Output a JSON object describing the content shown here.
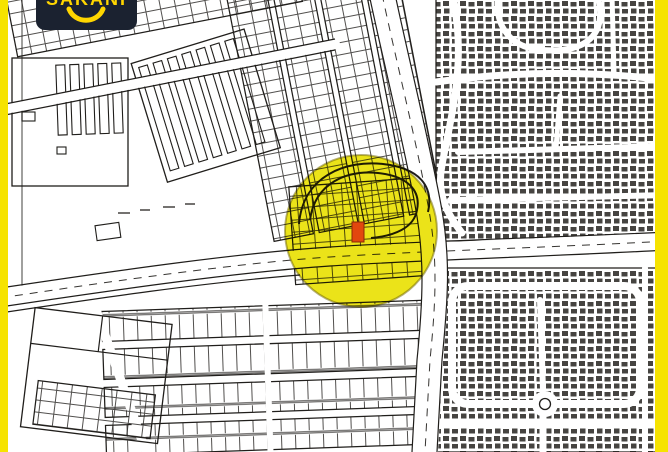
{
  "logo": {
    "text": "SAKANI"
  },
  "highlight": {
    "center_x": 361,
    "center_y": 231,
    "radius": 76
  },
  "marker": {
    "x": 352,
    "y": 222,
    "width": 12,
    "height": 20
  },
  "colors": {
    "frame_yellow": "#f6e300",
    "highlight_yellow": "#e9e000",
    "highlight_outline": "#6b6200",
    "marker_red": "#e2470e",
    "marker_red_dark": "#8a2a06",
    "logo_bg": "#1b2230",
    "logo_yellow": "#ffd600",
    "map_ink": "#201e1b",
    "map_bg": "#ffffff"
  }
}
